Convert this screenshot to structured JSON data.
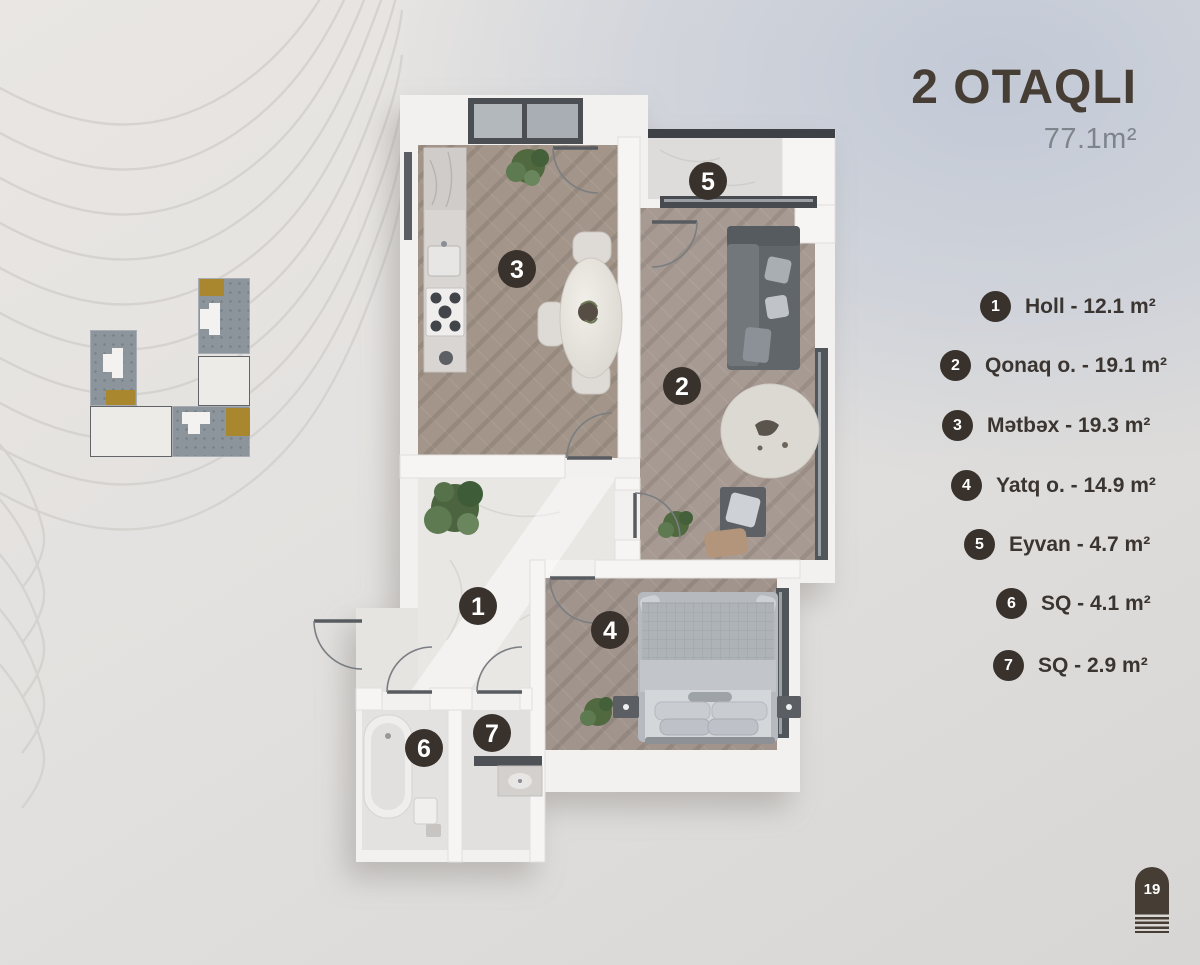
{
  "header": {
    "title": "2 OTAQLI",
    "area": "77.1m²"
  },
  "legend": {
    "items": [
      {
        "number": "1",
        "text": "Holl - 12.1 m²"
      },
      {
        "number": "2",
        "text": "Qonaq o. - 19.1 m²"
      },
      {
        "number": "3",
        "text": "Mətbəx - 19.3 m²"
      },
      {
        "number": "4",
        "text": "Yatq o. - 14.9 m²"
      },
      {
        "number": "5",
        "text": "Eyvan - 4.7 m²"
      },
      {
        "number": "6",
        "text": "SQ - 4.1 m²"
      },
      {
        "number": "7",
        "text": "SQ - 2.9 m²"
      }
    ]
  },
  "plan": {
    "markers": [
      "1",
      "2",
      "3",
      "4",
      "5",
      "6",
      "7"
    ]
  },
  "page_badge": {
    "number": "19"
  },
  "colors": {
    "accent_dark": "#39322c",
    "title_text": "#463d35",
    "area_text": "#7f838c",
    "highlight_gold": "#a8872e",
    "map_gray": "#8d959c",
    "wood_floor": "#a39589",
    "marble_floor": "#e9e7e4",
    "window_frame": "#4b4f53",
    "background_blue": "#c2c9d6",
    "background_beige": "#e6e3e1"
  }
}
